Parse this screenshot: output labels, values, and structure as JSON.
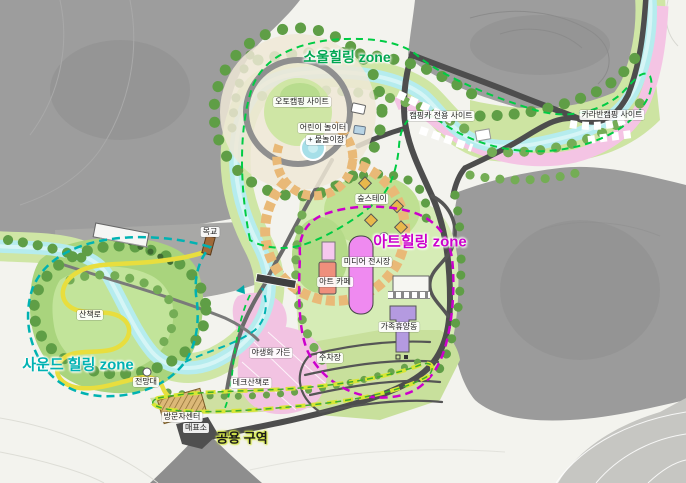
{
  "map": {
    "zones": [
      {
        "id": "soul-healing",
        "label": "소울힐링 zone",
        "color": "#00a651"
      },
      {
        "id": "art-healing",
        "label": "아트힐링 zone",
        "color": "#cc00cc"
      },
      {
        "id": "sound-healing",
        "label": "사운드 힐링 zone",
        "color": "#00b2b2"
      },
      {
        "id": "common-area",
        "label": "공용 구역",
        "color": "#1a1a1a",
        "halo": "#d6e84a"
      }
    ],
    "labels": [
      {
        "id": "auto-camping-site",
        "text": "오토캠핑 사이트"
      },
      {
        "id": "camping-car-site",
        "text": "캠핑카 전용 사이트"
      },
      {
        "id": "caravan-camping-site",
        "text": "카라반캠핑 사이트"
      },
      {
        "id": "children-playground",
        "text": "어린이 놀이터"
      },
      {
        "id": "water-play-area",
        "text": "+ 물놀이장"
      },
      {
        "id": "forest-stay",
        "text": "숲스테이"
      },
      {
        "id": "media-exhibition-hall",
        "text": "미디어 전시장"
      },
      {
        "id": "art-cafe",
        "text": "아트 카페"
      },
      {
        "id": "family-resort-building",
        "text": "가족휴양동"
      },
      {
        "id": "parking-lot",
        "text": "주차장"
      },
      {
        "id": "wildflower-garden",
        "text": "야생화 가든"
      },
      {
        "id": "deck-walkway",
        "text": "데크산책로"
      },
      {
        "id": "walking-trail",
        "text": "산책로"
      },
      {
        "id": "wooden-bridge",
        "text": "목교"
      },
      {
        "id": "observatory",
        "text": "전망대"
      },
      {
        "id": "visitor-center",
        "text": "방문자센터"
      },
      {
        "id": "ticket-office",
        "text": "매표소"
      }
    ],
    "colors": {
      "stream": "#b5ecee",
      "pink_path": "#f4c4e4",
      "road_dark": "#4d4d4d",
      "mountain_gray": "#9c9c9c",
      "vegetation_light": "#cfe6a5",
      "vegetation_dark": "#5f9e46",
      "meadow": "#a9d47d",
      "camp_pad": "#e9b977",
      "trail_yellow": "#e8de3e",
      "soul_zone_dash": "#00cc44",
      "art_zone_dash": "#cc00cc",
      "sound_zone_dash": "#00b2b2",
      "common_zone_dash": "#d8e635",
      "building_magenta": "#ef8af0",
      "building_purple": "#b49ae0",
      "building_salmon": "#ef8f7c",
      "pool_blue": "#a6dfe8"
    }
  }
}
